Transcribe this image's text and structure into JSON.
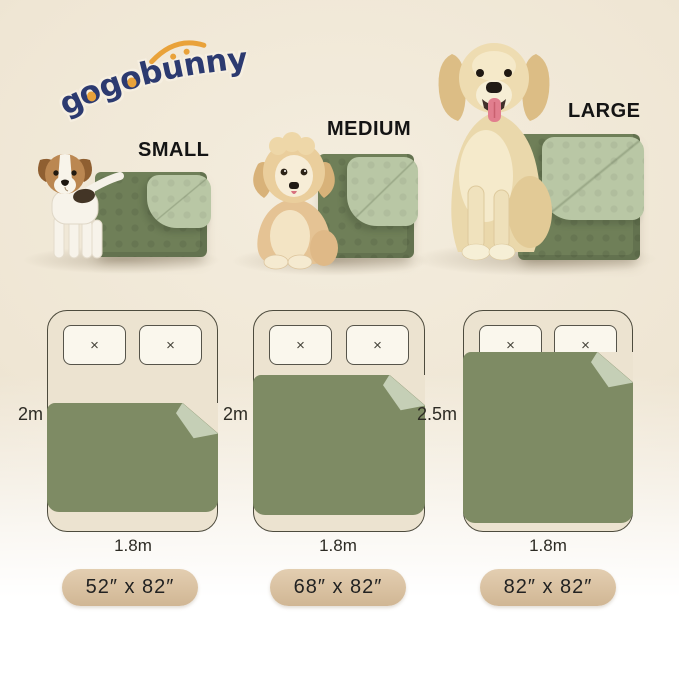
{
  "brand": {
    "logo_text": "gogobunny"
  },
  "sizes": [
    {
      "id": "small",
      "label": "SMALL",
      "bed_length": "2m",
      "bed_width": "1.8m",
      "blanket_size": "52″ x 82″"
    },
    {
      "id": "medium",
      "label": "MEDIUM",
      "bed_length": "2m",
      "bed_width": "1.8m",
      "blanket_size": "68″ x 82″"
    },
    {
      "id": "large",
      "label": "LARGE",
      "bed_length": "2.5m",
      "bed_width": "1.8m",
      "blanket_size": "82″ x 82″"
    }
  ],
  "bed_diagram": {
    "pillow_mark": "×"
  },
  "colors": {
    "logo_navy": "#2c3a70",
    "logo_orange": "#e9a23a",
    "photo_blanket_dark": "#6f7f58",
    "photo_blanket_light": "#b9c7a5",
    "diagram_blanket_dark": "#7e8b64",
    "diagram_blanket_light": "#c5cfb6",
    "badge_tan": "#d9c1a1",
    "badge_tan_light": "#e3ceb1"
  }
}
